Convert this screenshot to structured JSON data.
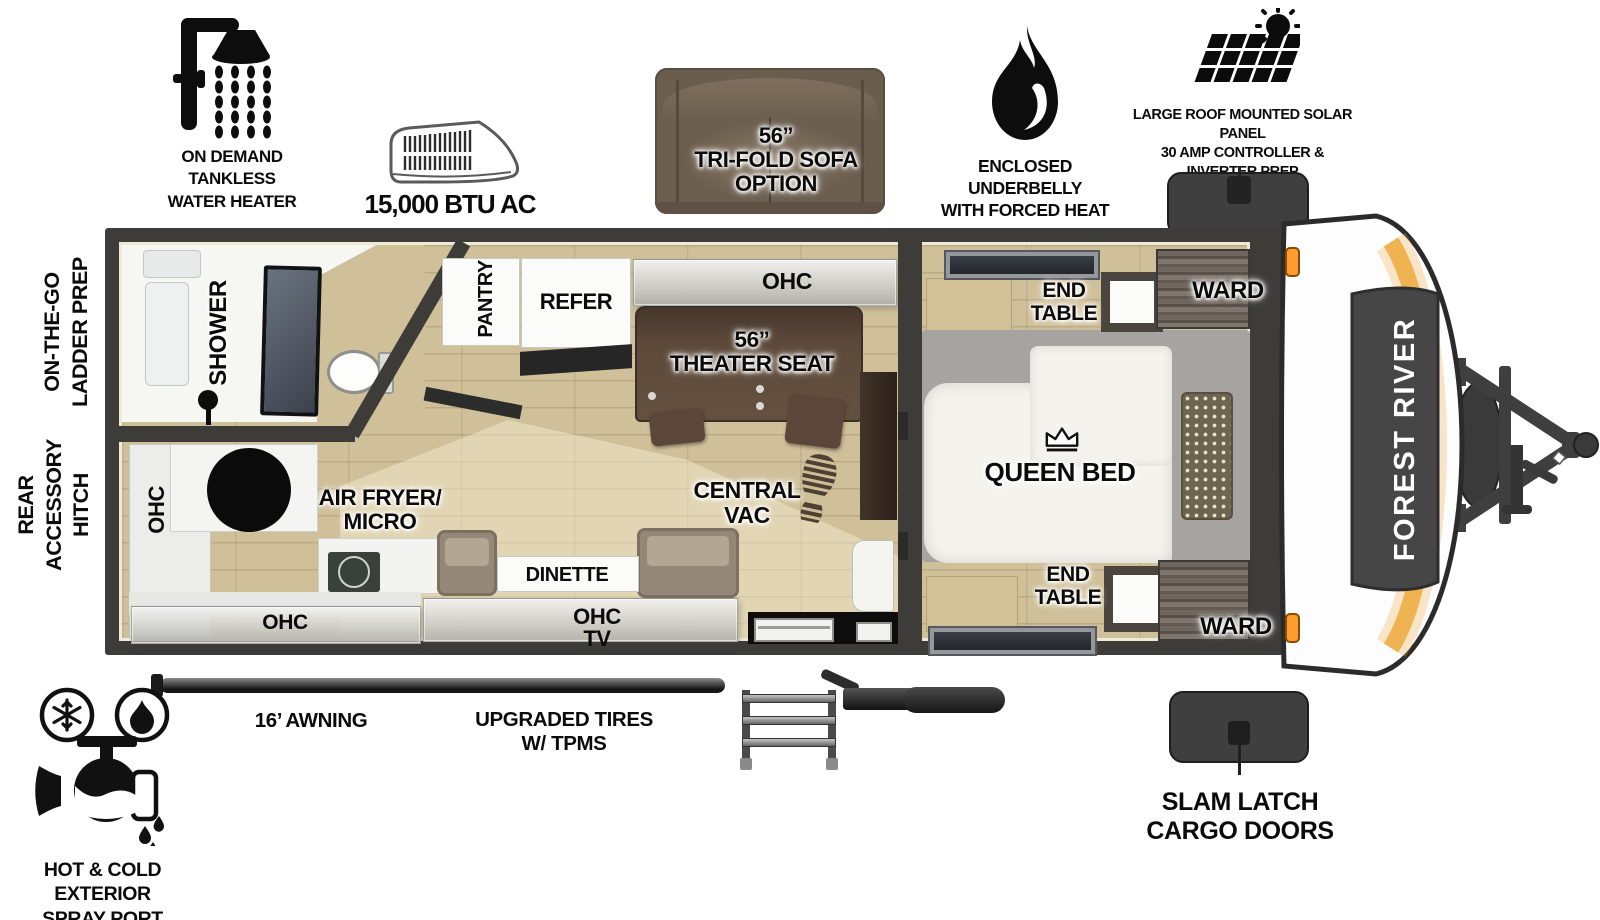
{
  "brand": {
    "name": "FOREST RIVER"
  },
  "top_features": {
    "water_heater": {
      "icon": "shower-icon",
      "label": "ON DEMAND\nTANKLESS\nWATER HEATER"
    },
    "ac": {
      "icon": "ac-unit-icon",
      "label": "15,000 BTU AC"
    },
    "sofa_option": {
      "icon": "tri-fold-sofa-icon",
      "label": "56”\nTRI-FOLD SOFA\nOPTION"
    },
    "underbelly": {
      "icon": "flame-icon",
      "label": "ENCLOSED UNDERBELLY\nWITH FORCED HEAT"
    },
    "solar": {
      "icon": "solar-panel-icon",
      "label": "LARGE ROOF MOUNTED SOLAR PANEL\n30 AMP CONTROLLER & INVERTER PREP"
    }
  },
  "side_features": {
    "ladder_prep": "ON-THE-GO\nLADDER PREP",
    "rear_hitch": "REAR\nACCESSORY\nHITCH"
  },
  "bottom_features": {
    "awning": "16’ AWNING",
    "tires": "UPGRADED TIRES\nW/ TPMS",
    "cargo_doors": "SLAM LATCH\nCARGO DOORS",
    "spray_port": "HOT & COLD EXTERIOR\nSPRAY PORT"
  },
  "floorplan": {
    "bathroom": {
      "shower": "SHOWER"
    },
    "galley": {
      "pantry": "PANTRY",
      "refer": "REFER",
      "ohc": "OHC",
      "theater_seat": "56”\nTHEATER SEAT",
      "central_vac": "CENTRAL\nVAC"
    },
    "kitchen": {
      "ohc_side": "OHC",
      "ohc_bottom": "OHC",
      "air_fryer_micro": "AIR FRYER/\nMICRO",
      "dinette": "DINETTE",
      "ohc_tv": "OHC\nTV"
    },
    "bedroom": {
      "queen_bed": "QUEEN BED",
      "end_table_top": "END\nTABLE",
      "end_table_bottom": "END\nTABLE",
      "ward_top": "WARD",
      "ward_bottom": "WARD"
    }
  },
  "colors": {
    "wall": "#3d3c39",
    "floor_wood": "#cfc09a",
    "theater_brown": "#5d4a3b",
    "sofa_brown": "#6b5d4e",
    "accent_orange": "#eeb04b",
    "cargo_door": "#3f3f3f"
  }
}
